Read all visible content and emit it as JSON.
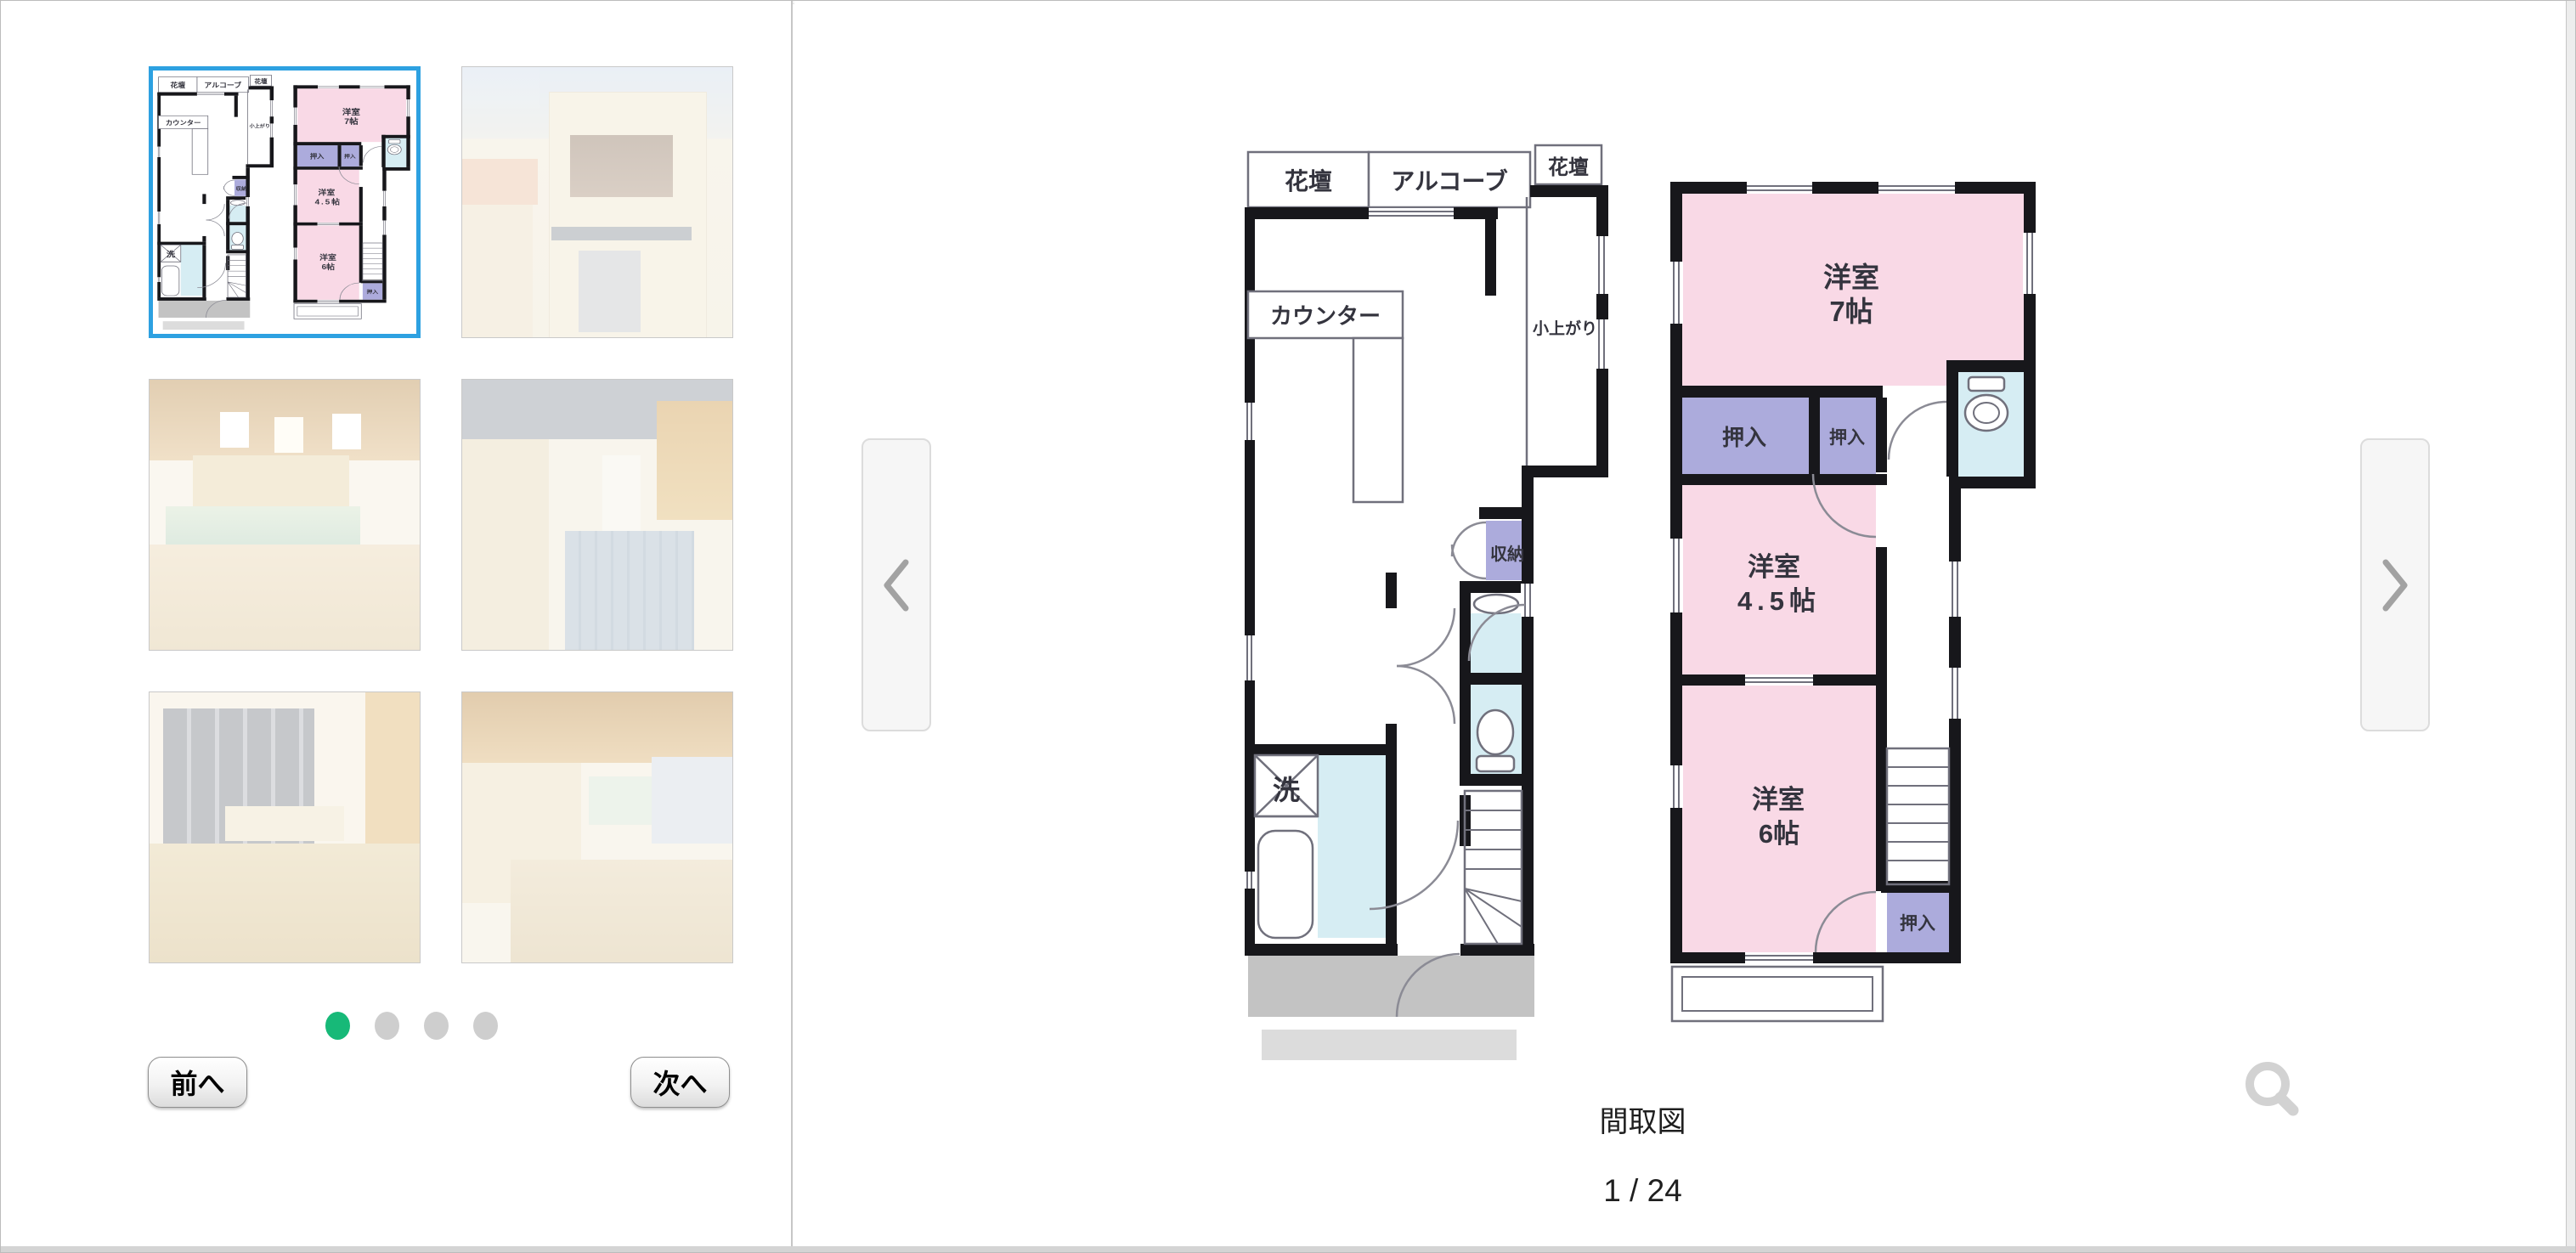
{
  "sidebar": {
    "thumbnails": [
      {
        "name": "floor-plan",
        "selected": true
      },
      {
        "name": "building-exterior",
        "selected": false
      },
      {
        "name": "interior-counter",
        "selected": false
      },
      {
        "name": "interior-corridor",
        "selected": false
      },
      {
        "name": "interior-window-room",
        "selected": false
      },
      {
        "name": "interior-counter-2",
        "selected": false
      }
    ],
    "pagination": {
      "dot_count": 4,
      "active_dot": 1
    },
    "prev_label": "前へ",
    "next_label": "次へ"
  },
  "viewer": {
    "caption": "間取図",
    "page_indicator": "1 / 24",
    "prev_arrow_icon": "chevron-left",
    "next_arrow_icon": "chevron-right",
    "zoom_icon": "magnifier"
  },
  "floor_plan": {
    "floor1": {
      "flower_bed_left": "花壇",
      "alcove": "アルコーブ",
      "flower_bed_right": "花壇",
      "counter": "カウンター",
      "raised_floor": "小上がり",
      "storage": "収納",
      "laundry": "洗"
    },
    "floor2": {
      "room1_name": "洋室",
      "room1_size": "7帖",
      "closet1": "押入",
      "closet2": "押入",
      "room2_name": "洋室",
      "room2_size": "4.5帖",
      "room3_name": "洋室",
      "room3_size": "6帖",
      "closet3": "押入"
    },
    "colors": {
      "room_pink": "#f9d9e6",
      "closet_purple": "#acabdc",
      "wet_cyan": "#d6edf3",
      "wall_black": "#17171b",
      "entrance_gray": "#c3c3c3",
      "accent_green": "#17b978",
      "selected_blue": "#2da1e1"
    }
  }
}
